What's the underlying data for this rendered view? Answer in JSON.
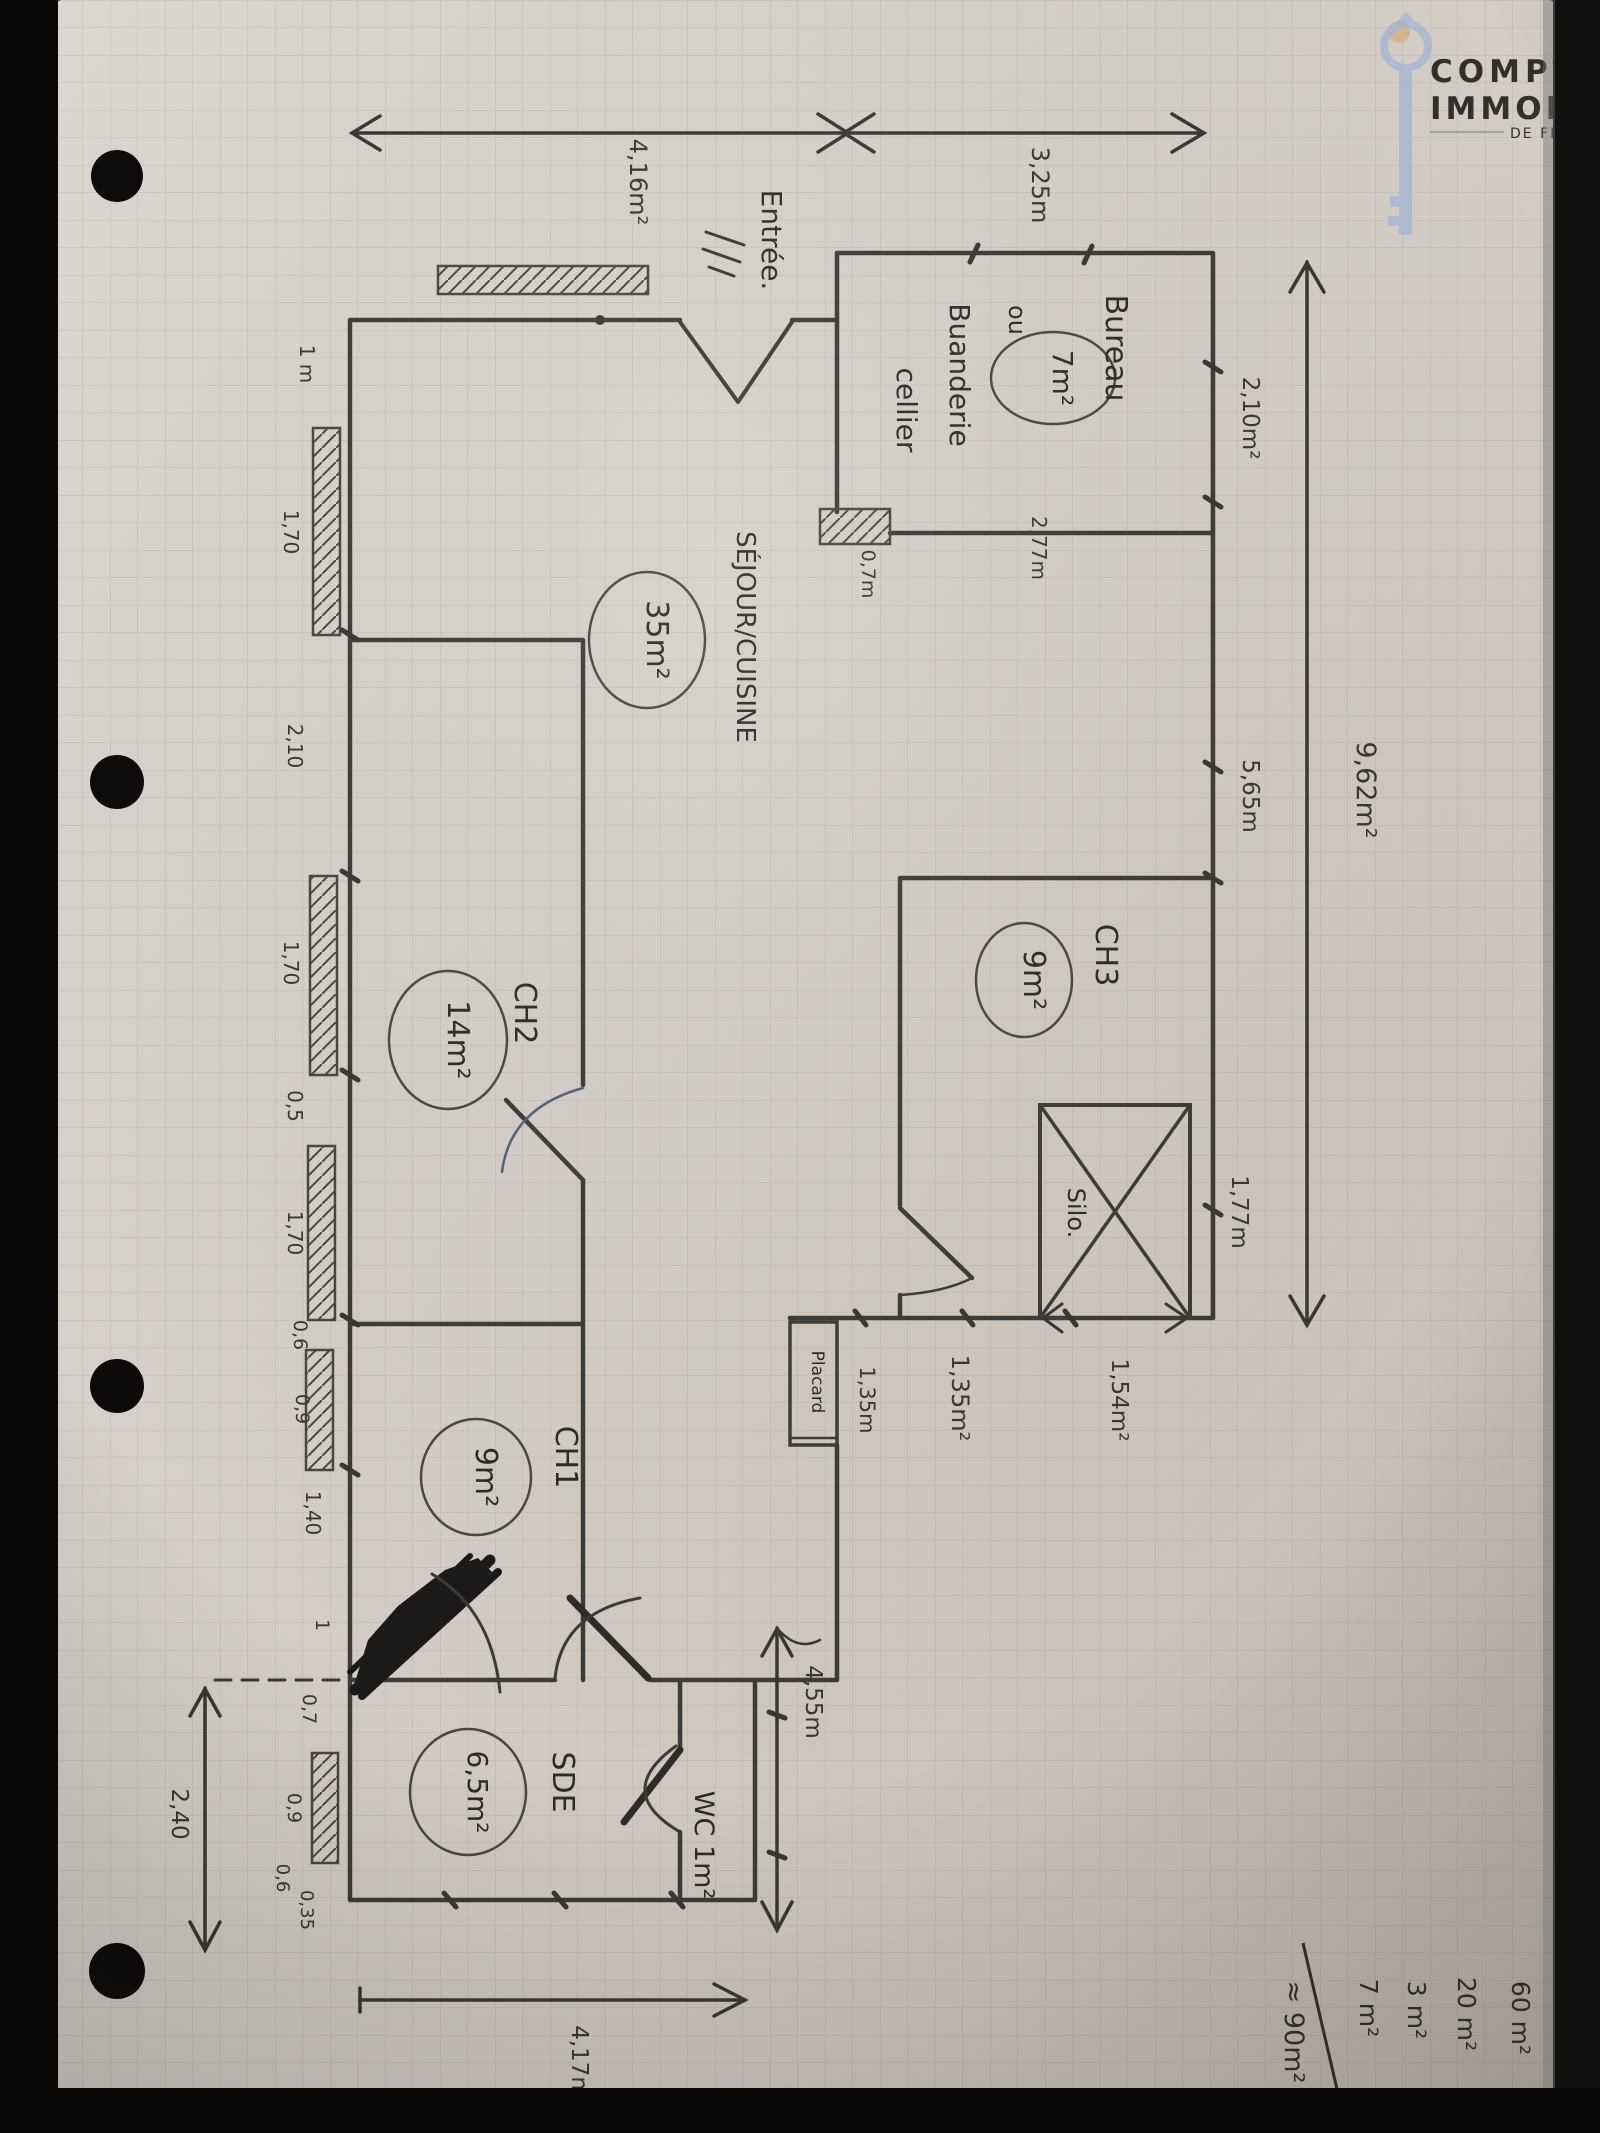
{
  "watermark": {
    "line1": "COMPTOIR",
    "line2": "IMMOBILIER",
    "line3": "DE FRANCE"
  },
  "dims": {
    "top_left": "4,16m²",
    "top_mid": "3,25m",
    "bureau_side": "2,10m²",
    "bureau_bottom": "2,77m",
    "bureau_door": "0,7m",
    "right_upper": "5,65m",
    "overall_width": "9,62m²",
    "right_lower": "1,77m",
    "silo": "1,54m²",
    "corridor": "1,35m²",
    "placard": "1,35m",
    "hall_height": "4,55m",
    "ext_left": "2,40",
    "bottom_width": "4,17m",
    "e1": "1 m",
    "e2": "1,70",
    "e3": "2,10",
    "e4": "1,70",
    "e5": "0,5",
    "e6": "1,70",
    "e7": "0,6",
    "e8": "0,9",
    "e9": "1,40",
    "e10": "1",
    "e11": "0,7",
    "e12": "0,9",
    "e13": "0,6",
    "e14": "0,35"
  },
  "rooms": {
    "entree": "Entrée.",
    "bureau": "Bureau",
    "ou": "ou",
    "bureau_area": "7m²",
    "buanderie": "Buanderie",
    "cellier": "cellier",
    "sejour": "SÉJOUR/CUISINE",
    "sejour_area": "35m²",
    "ch3": "CH3",
    "ch3_area": "9m²",
    "ch2": "CH2",
    "ch2_area": "14m²",
    "ch1": "CH1",
    "ch1_area": "9m²",
    "sde": "SDE",
    "sde_area": "6,5m²",
    "wc": "WC 1m²",
    "silo": "Silo.",
    "placard": "Placard"
  },
  "totals": {
    "v1": "60 m²",
    "v2": "20 m²",
    "v3": "3 m²",
    "v4": "7 m²",
    "sum": "≈ 90m²"
  }
}
